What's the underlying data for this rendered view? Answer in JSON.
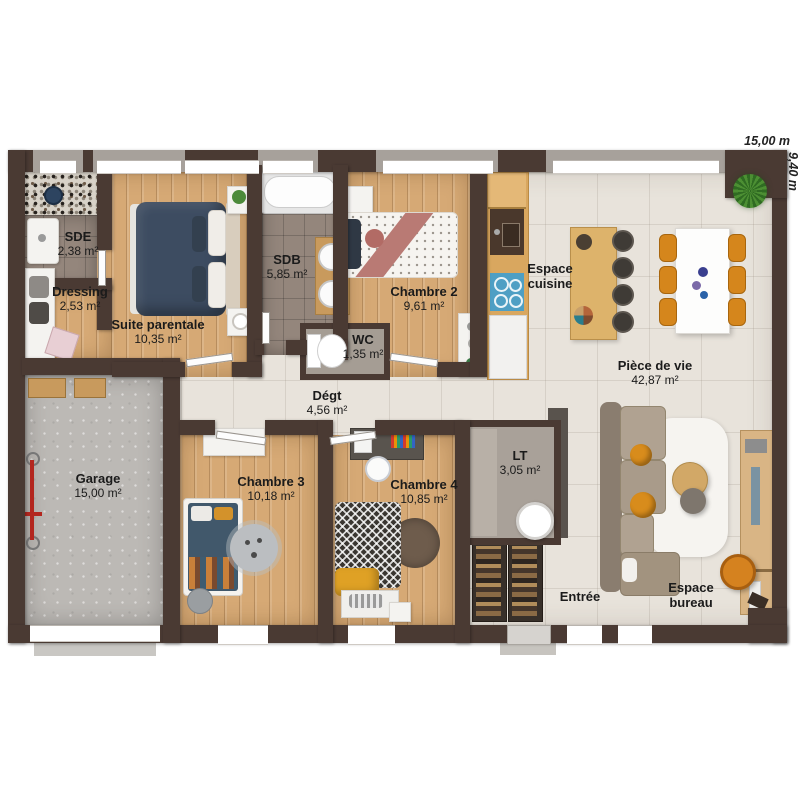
{
  "dimensions": {
    "width_label": "15,00 m",
    "depth_label": "9,40 m"
  },
  "rooms": {
    "sde": {
      "name": "SDE",
      "area": "2,38 m²"
    },
    "dressing": {
      "name": "Dressing",
      "area": "2,53 m²"
    },
    "suite_parentale": {
      "name": "Suite parentale",
      "area": "10,35 m²"
    },
    "sdb": {
      "name": "SDB",
      "area": "5,85 m²"
    },
    "chambre2": {
      "name": "Chambre 2",
      "area": "9,61 m²"
    },
    "wc": {
      "name": "WC",
      "area": "1,35 m²"
    },
    "degt": {
      "name": "Dégt",
      "area": "4,56 m²"
    },
    "garage": {
      "name": "Garage",
      "area": "15,00 m²"
    },
    "chambre3": {
      "name": "Chambre 3",
      "area": "10,18 m²"
    },
    "chambre4": {
      "name": "Chambre 4",
      "area": "10,85 m²"
    },
    "lt": {
      "name": "LT",
      "area": "3,05 m²"
    },
    "espace_cuisine": {
      "name": "Espace cuisine"
    },
    "piece_de_vie": {
      "name": "Pièce de vie",
      "area": "42,87 m²"
    },
    "entree": {
      "name": "Entrée"
    },
    "espace_bureau": {
      "name": "Espace bureau"
    }
  },
  "colors": {
    "wall": "#4a3a33",
    "wood_floor": "#d6a975",
    "light_tile": "#e8e3db",
    "bath_tile": "#94867c",
    "concrete": "#bcb9b5",
    "accent_orange": "#d5861c",
    "bed_navy": "#3d4c61",
    "cooktop_blue": "#4e9fc4"
  }
}
